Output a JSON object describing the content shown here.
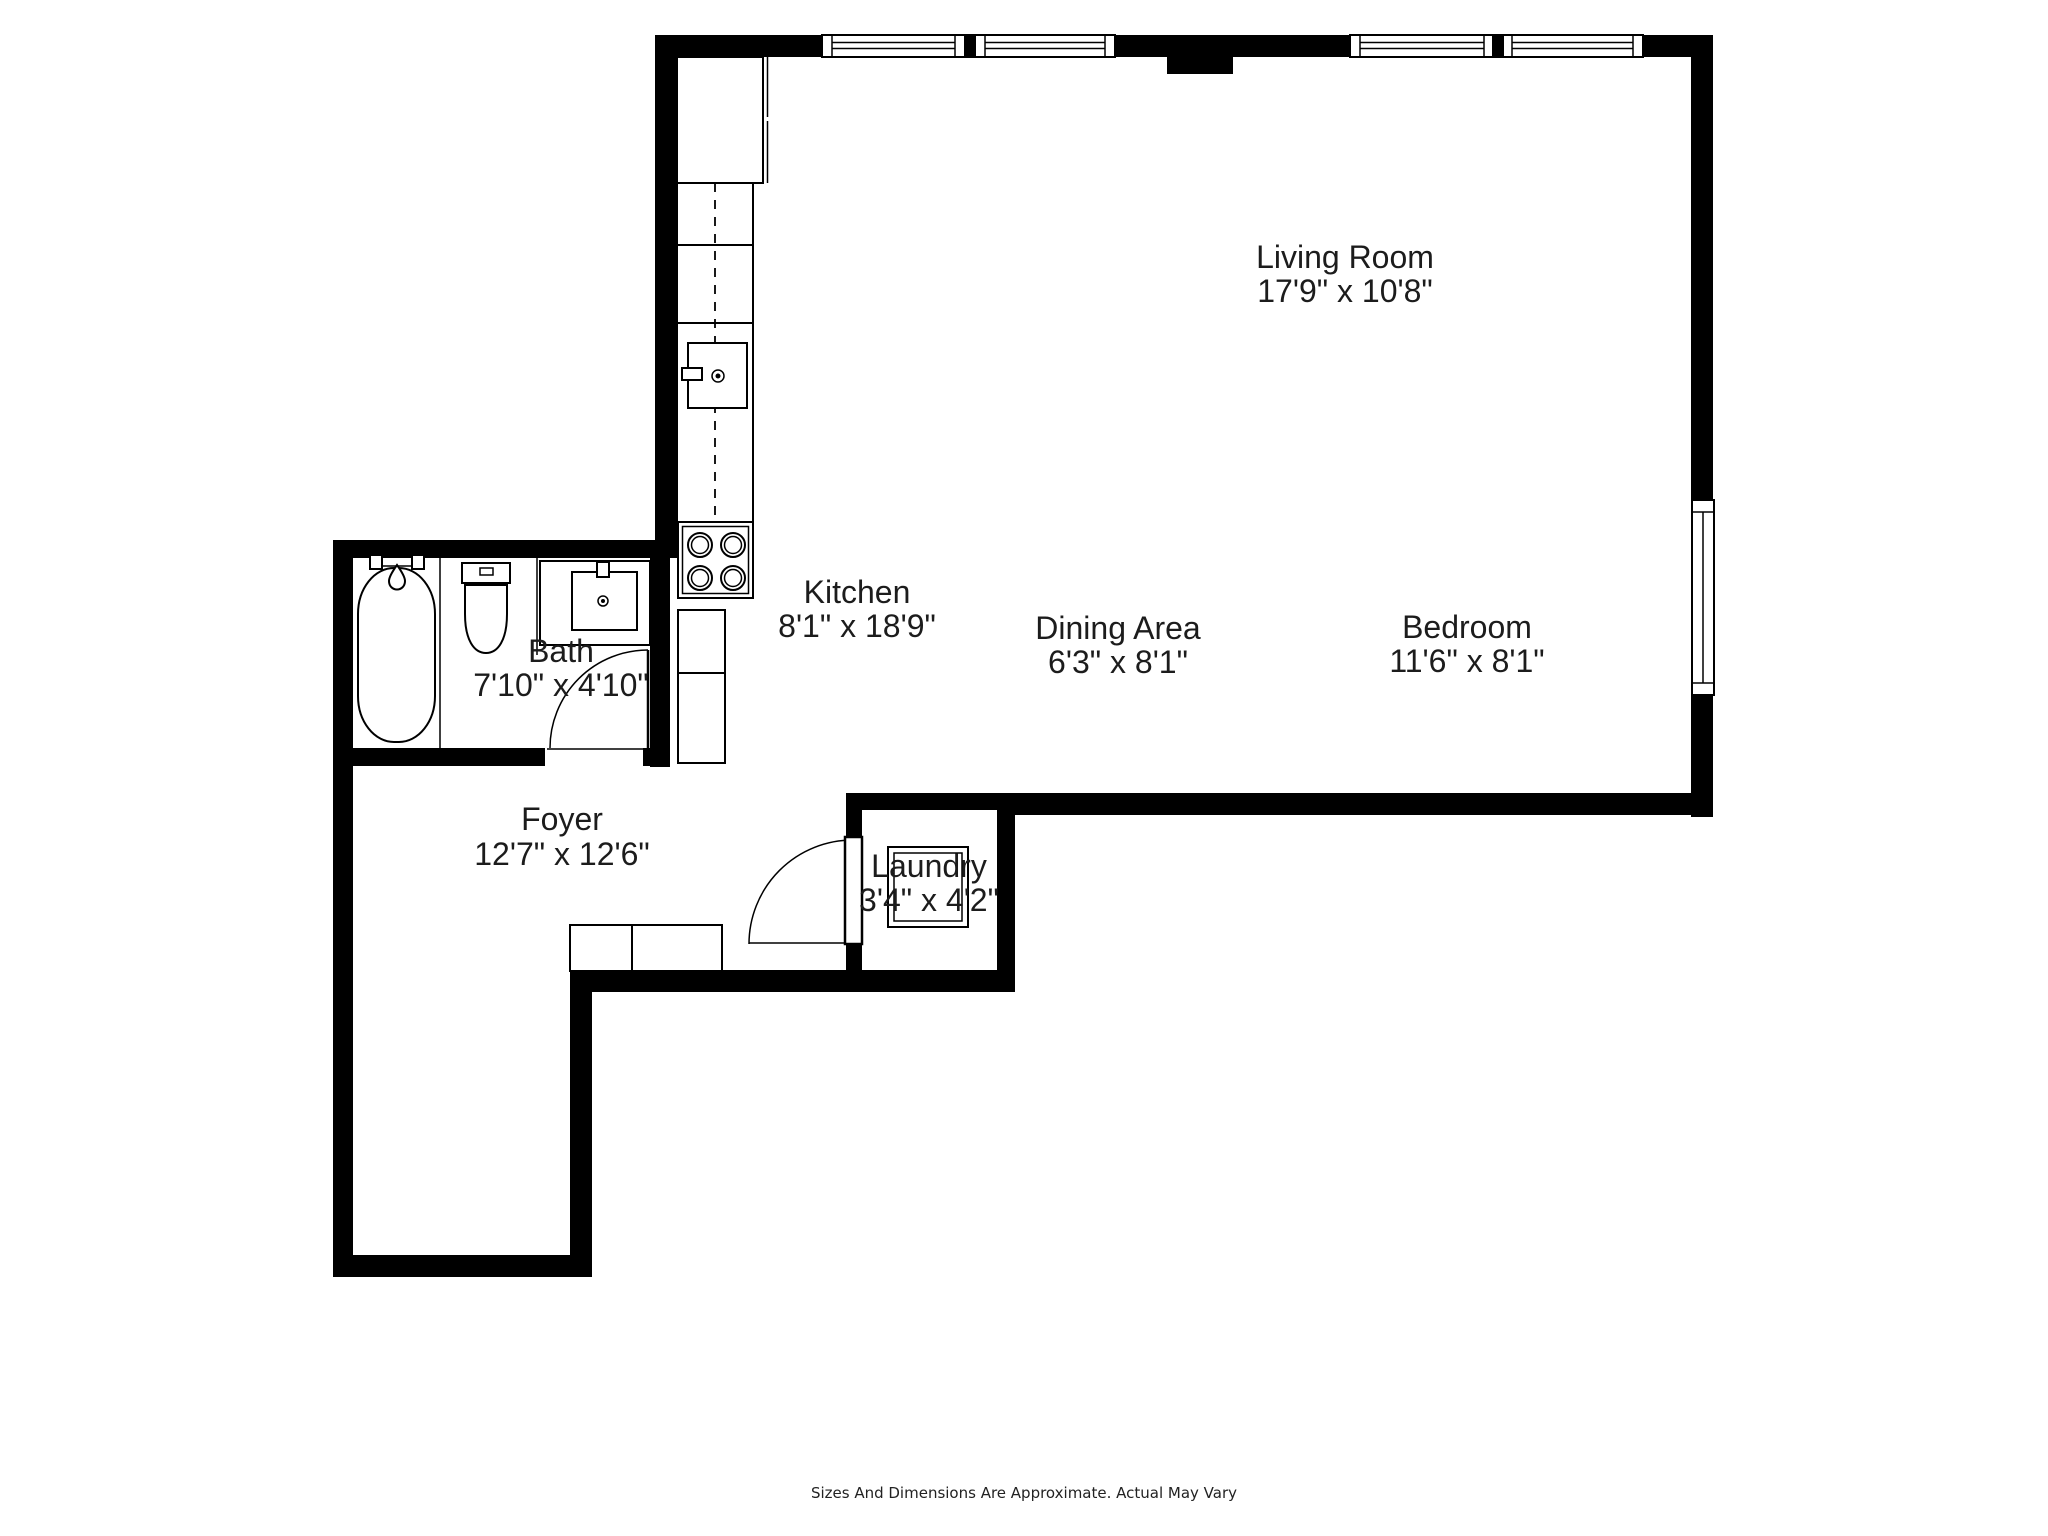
{
  "disclaimer": "Sizes And Dimensions Are Approximate. Actual May Vary",
  "colors": {
    "wall": "#000000",
    "fixture_line": "#000000",
    "label_text": "#1c1c1c",
    "background": "#ffffff"
  },
  "rooms": [
    {
      "id": "living-room",
      "name": "Living Room",
      "dimensions": "17'9\" x 10'8\""
    },
    {
      "id": "kitchen",
      "name": "Kitchen",
      "dimensions": "8'1\" x 18'9\""
    },
    {
      "id": "dining-area",
      "name": "Dining Area",
      "dimensions": "6'3\" x 8'1\""
    },
    {
      "id": "bedroom",
      "name": "Bedroom",
      "dimensions": "11'6\" x 8'1\""
    },
    {
      "id": "bath",
      "name": "Bath",
      "dimensions": "7'10\" x 4'10\""
    },
    {
      "id": "foyer",
      "name": "Foyer",
      "dimensions": "12'7\" x 12'6\""
    },
    {
      "id": "laundry",
      "name": "Laundry",
      "dimensions": "3'4\" x 4'2\""
    }
  ]
}
